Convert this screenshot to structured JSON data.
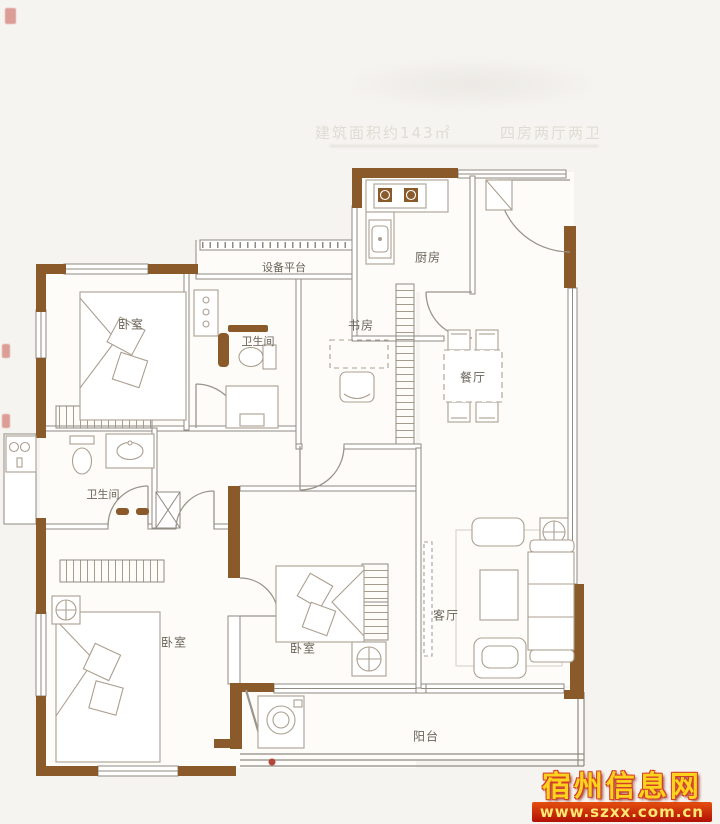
{
  "header": {
    "area_label": "建筑面积约143㎡",
    "layout_label": "四房两厅两卫"
  },
  "rooms": {
    "bedroom_top_left": "卧室",
    "equipment_platform": "设备平台",
    "bathroom_top": "卫生间",
    "study": "书房",
    "kitchen": "厨房",
    "dining": "餐厅",
    "bathroom_mid": "卫生间",
    "bedroom_bottom_left": "卧室",
    "bedroom_middle": "卧室",
    "living": "客厅",
    "balcony": "阳台"
  },
  "watermark": {
    "site_name": "宿州信息网",
    "site_url": "www.szxx.com.cn"
  },
  "palette": {
    "wall_brown": "#8a5a2b",
    "line_gray": "#8f8a82",
    "furniture_gray": "#ab9f90",
    "background": "#f6f4f0",
    "watermark_yellow": "#ffd21e",
    "watermark_red": "#c03012"
  }
}
